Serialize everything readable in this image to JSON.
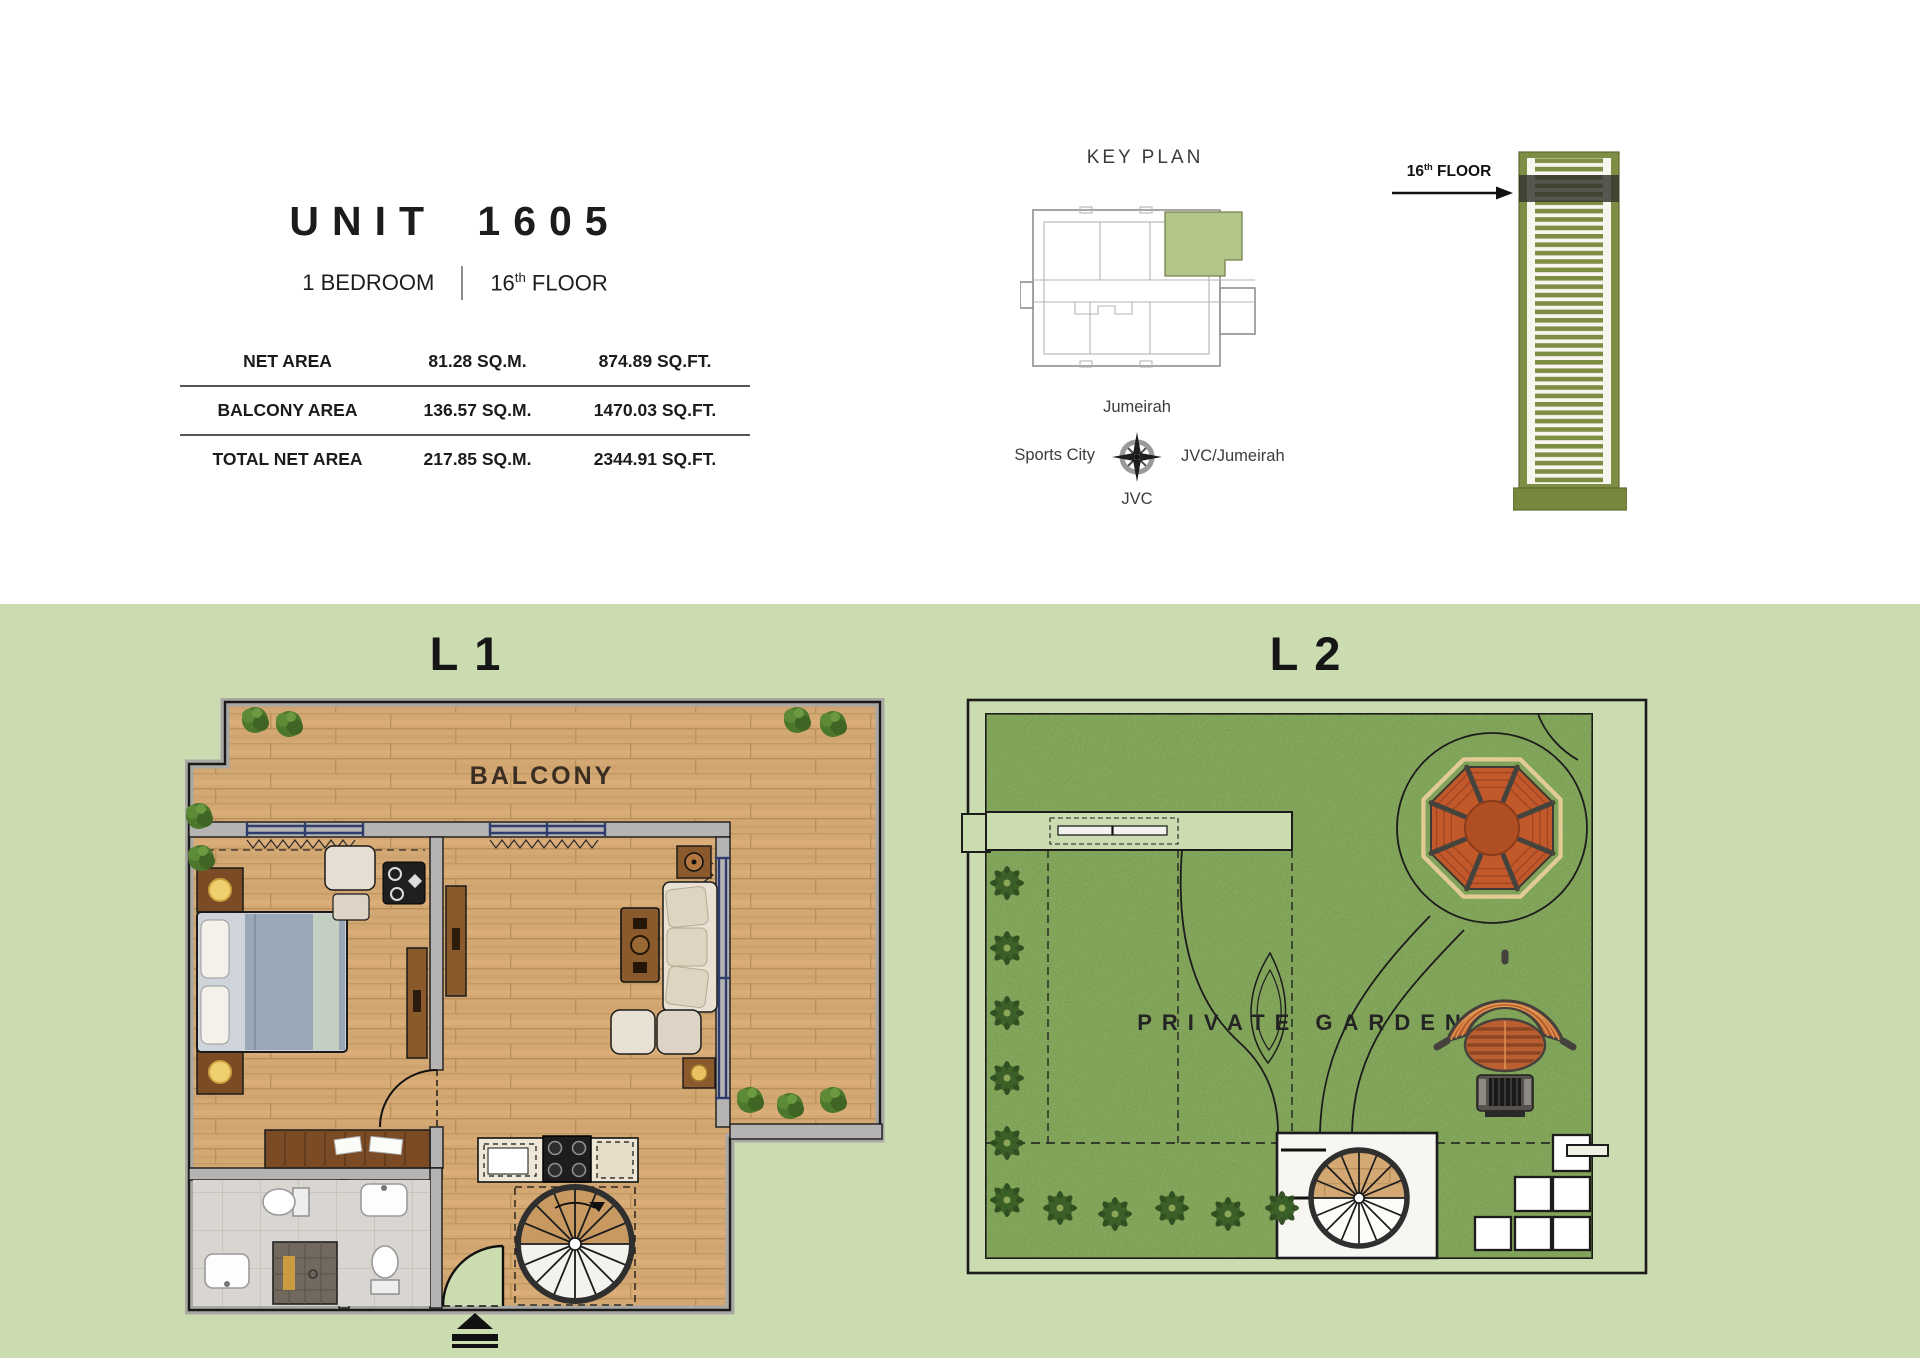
{
  "header": {
    "unit_title": "UNIT 1605",
    "bedroom_label": "1 BEDROOM",
    "floor_number": "16",
    "floor_suffix": "th",
    "floor_word": "FLOOR",
    "area_table": {
      "rows": [
        {
          "label": "NET AREA",
          "sqm": "81.28 SQ.M.",
          "sqft": "874.89 SQ.FT."
        },
        {
          "label": "BALCONY AREA",
          "sqm": "136.57 SQ.M.",
          "sqft": "1470.03 SQ.FT."
        },
        {
          "label": "TOTAL NET AREA",
          "sqm": "217.85 SQ.M.",
          "sqft": "2344.91 SQ.FT."
        }
      ]
    }
  },
  "keyplan": {
    "title": "KEY PLAN",
    "labels": {
      "north": "Jumeirah",
      "west": "Sports City",
      "east": "JVC/Jumeirah",
      "south": "JVC"
    },
    "unit_highlight_color": "#b2c687"
  },
  "tower": {
    "floor_number": "16",
    "floor_suffix": "th",
    "floor_word": "FLOOR",
    "body_color": "#7e8e44"
  },
  "levels": {
    "l1": {
      "title": "L1",
      "balcony_label": "BALCONY"
    },
    "l2": {
      "title": "L2",
      "garden_label": "PRIVATE GARDEN"
    }
  },
  "colors": {
    "section_background": "#cbddb0",
    "grass": "#7fa355",
    "wood_floor": "#d4a873",
    "gazebo_orange": "#c2592b",
    "wall_gray": "#b5b4b2",
    "window_blue": "#2e3d6e"
  }
}
